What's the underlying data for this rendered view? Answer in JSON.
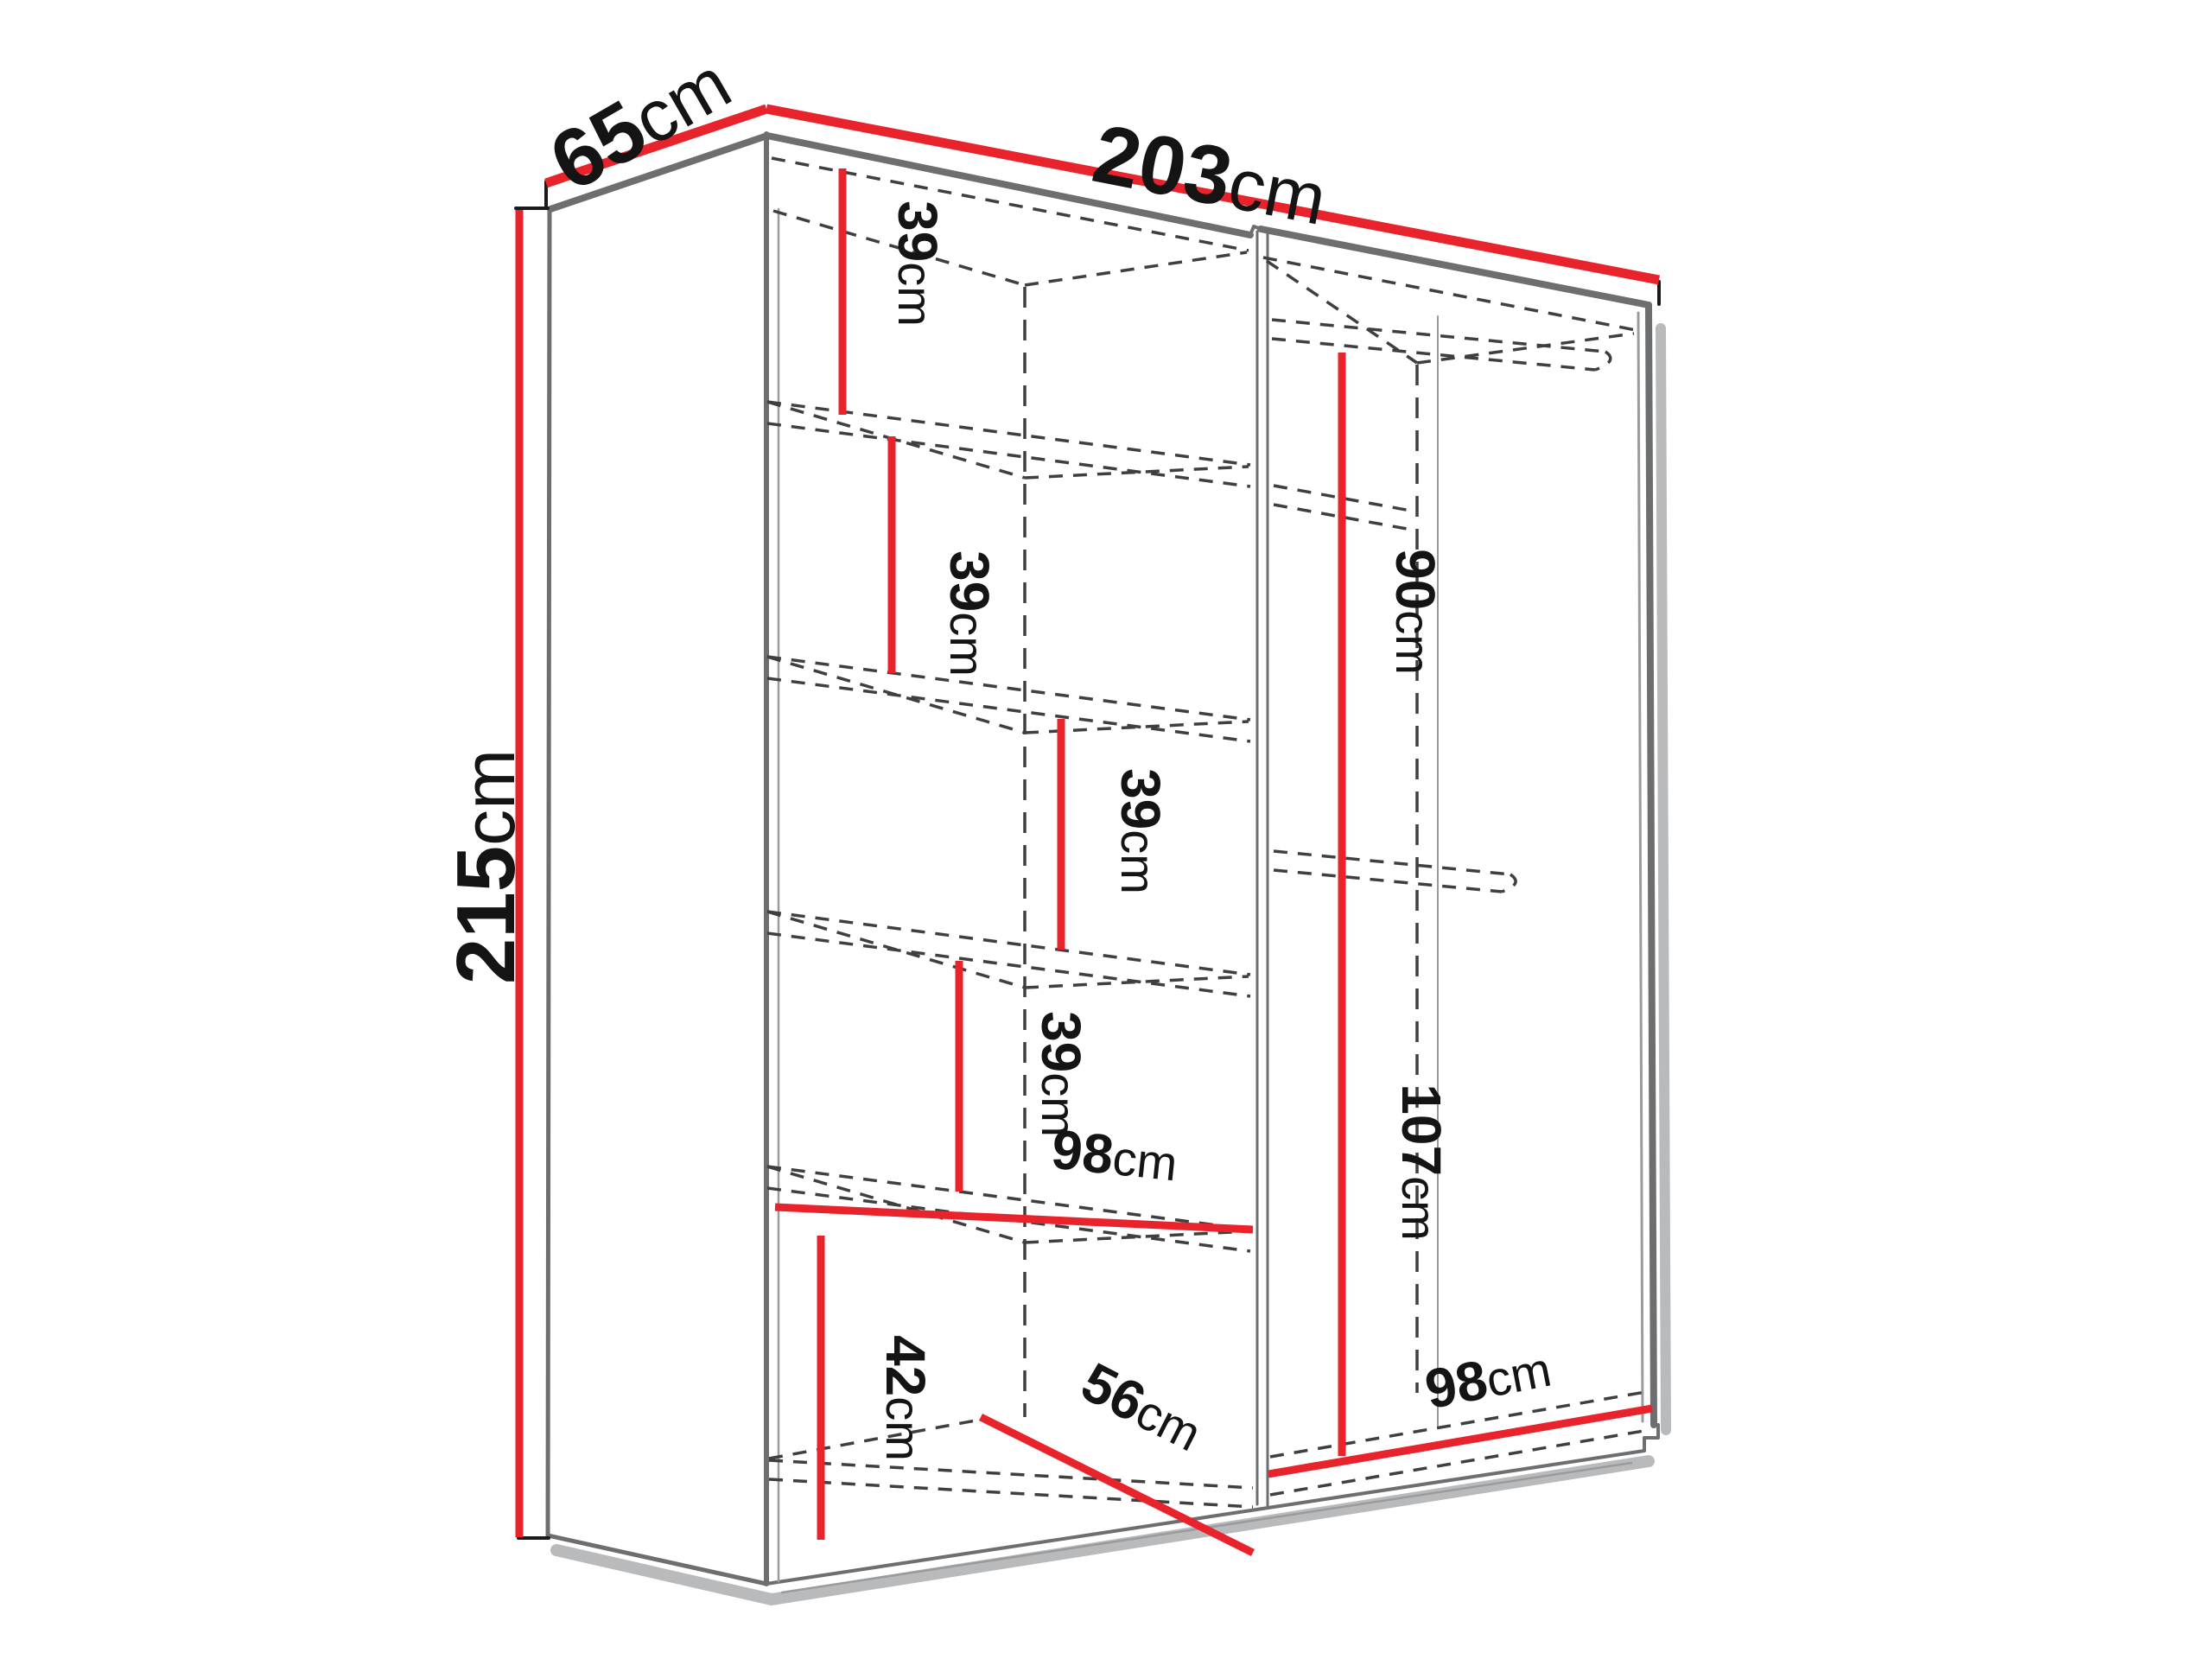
{
  "diagram": {
    "title": "wardrobe-dimension-diagram",
    "units": "cm",
    "colors": {
      "dimension_line": "#e8232b",
      "outline": "#6d6e70",
      "outline_thin": "#9a9b9d",
      "dashed": "#3f3f3f",
      "shadow": "#b9babc",
      "caps": "#1a1a1a",
      "text": "#141414",
      "background": "#ffffff"
    },
    "overall": {
      "depth": {
        "value": "65",
        "unit": "cm"
      },
      "width": {
        "value": "203",
        "unit": "cm"
      },
      "height": {
        "value": "215",
        "unit": "cm"
      }
    },
    "labels": {
      "d65": {
        "value": "65",
        "unit": "cm"
      },
      "d203": {
        "value": "203",
        "unit": "cm"
      },
      "d215": {
        "value": "215",
        "unit": "cm"
      },
      "s39a": {
        "value": "39",
        "unit": "cm"
      },
      "s39b": {
        "value": "39",
        "unit": "cm"
      },
      "s39c": {
        "value": "39",
        "unit": "cm"
      },
      "s39d": {
        "value": "39",
        "unit": "cm"
      },
      "d98l": {
        "value": "98",
        "unit": "cm"
      },
      "d42": {
        "value": "42",
        "unit": "cm"
      },
      "d56": {
        "value": "56",
        "unit": "cm"
      },
      "d90": {
        "value": "90",
        "unit": "cm"
      },
      "d107": {
        "value": "107",
        "unit": "cm"
      },
      "d98r": {
        "value": "98",
        "unit": "cm"
      }
    }
  }
}
